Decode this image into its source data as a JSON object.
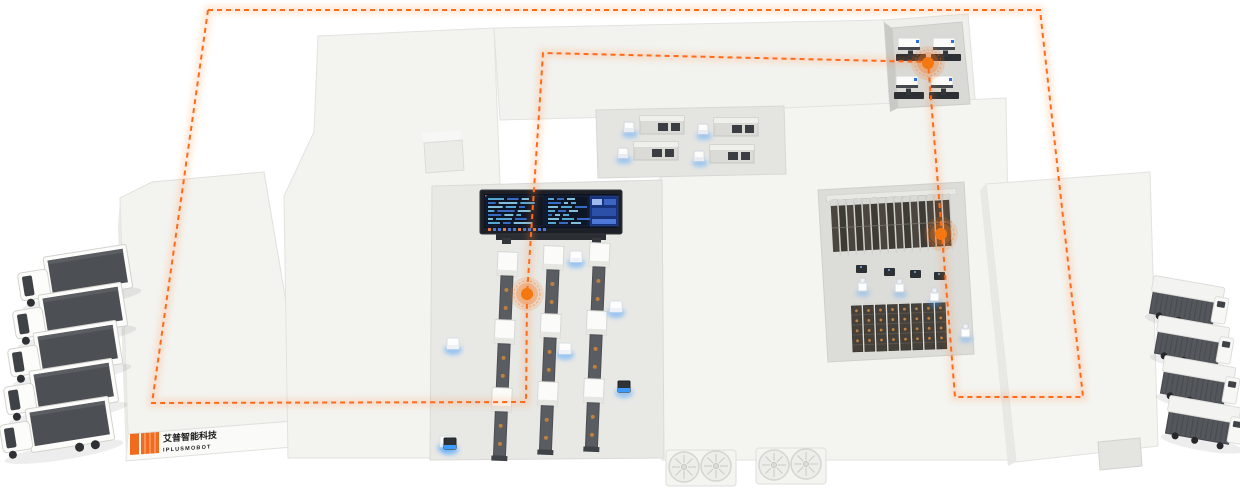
{
  "meta": {
    "title": "smart-factory-isometric-overview",
    "canvas": {
      "width": 1240,
      "height": 488
    }
  },
  "palette": {
    "background": "#ffffff",
    "roof_white": "#f4f4f1",
    "roof_white_2": "#f1f1ee",
    "roof_edge": "#dddddb",
    "floor_gray": "#e8e8e5",
    "floor_dark": "#dcdcd9",
    "wall_shadow": "#c9c9c6",
    "route_orange": "#ff6b1a",
    "node_orange": "#f4770f",
    "glow_blue": "#4aa3ff",
    "machine_dark": "#2e3136",
    "conveyor_gray": "#595c60",
    "rack_dark": "#3e3a34",
    "rack_dark_2": "#45403a",
    "truck_top": "#4c4f54",
    "van_side": "#54575c",
    "vehicle_white": "#fcfcfa",
    "screen_frame": "#1d2026",
    "screen_bg": "#0c1220",
    "screen_right_bg": "#17337c",
    "chip_orange": "#e07b39",
    "chip_blue": "#4d78d8",
    "item_orange_dot": "#c0813f"
  },
  "logo": {
    "line1": "艾普智能科技",
    "line2": "IPLUSMOBOT",
    "mark_color": "#f26a1b",
    "text_color": "#1c1c1a"
  },
  "route": {
    "color": "#ff6b1a",
    "dash": "5 4",
    "closed": true,
    "points": [
      [
        208,
        10
      ],
      [
        1040,
        10
      ],
      [
        1083,
        397
      ],
      [
        955,
        397
      ],
      [
        942,
        235
      ],
      [
        928,
        62
      ],
      [
        543,
        53
      ],
      [
        527,
        295
      ],
      [
        526,
        402
      ],
      [
        152,
        403
      ]
    ]
  },
  "nodes": [
    {
      "name": "route-node-machining-cell",
      "x": 928,
      "y": 63
    },
    {
      "name": "route-node-storage-rack",
      "x": 941,
      "y": 234
    },
    {
      "name": "route-node-production-line",
      "x": 527,
      "y": 294
    }
  ],
  "vehicles": {
    "trucks_left": {
      "count": 5,
      "positions": [
        [
          18,
          252
        ],
        [
          13,
          290
        ],
        [
          8,
          328
        ],
        [
          4,
          366
        ],
        [
          0,
          404
        ]
      ]
    },
    "vans_right": {
      "count": 4,
      "positions": [
        [
          1152,
          282
        ],
        [
          1157,
          322
        ],
        [
          1163,
          362
        ],
        [
          1168,
          402
        ]
      ]
    }
  },
  "production_lines": {
    "columns": [
      {
        "x": 508,
        "y": 252
      },
      {
        "x": 554,
        "y": 246
      },
      {
        "x": 600,
        "y": 243
      }
    ],
    "segments_per_column": 3
  },
  "corridor_machines": [
    [
      640,
      116
    ],
    [
      714,
      118
    ],
    [
      634,
      142
    ],
    [
      710,
      145
    ]
  ],
  "machining_machines": [
    [
      896,
      38
    ],
    [
      931,
      38
    ],
    [
      894,
      76
    ],
    [
      929,
      76
    ]
  ],
  "agvs_white": [
    [
      447,
      338
    ],
    [
      570,
      251
    ],
    [
      610,
      301
    ],
    [
      559,
      343
    ],
    [
      440,
      436
    ]
  ],
  "agvs_dark": [
    [
      618,
      381
    ],
    [
      444,
      438
    ]
  ],
  "rack_robots": [
    [
      858,
      282
    ],
    [
      895,
      283
    ],
    [
      930,
      292
    ],
    [
      961,
      328
    ]
  ],
  "rack_pallets": [
    [
      856,
      265
    ],
    [
      884,
      268
    ],
    [
      910,
      270
    ],
    [
      934,
      272
    ]
  ],
  "racks": {
    "upper": {
      "x": 832,
      "y": 200,
      "columns": 15,
      "col_w": 8,
      "height": 52
    },
    "lower": {
      "x": 852,
      "y": 306,
      "columns": 8,
      "col_w": 12,
      "height": 46
    }
  },
  "screen": {
    "x": 480,
    "y": 190,
    "w": 142,
    "h": 44,
    "row_colors": [
      "#5fb7e8",
      "#3d74d6",
      "#8fd2f2"
    ],
    "left_rows": 7,
    "mid_rows": 7,
    "chips": 12
  },
  "vents": {
    "pedestals": [
      [
        666,
        450
      ],
      [
        756,
        448
      ]
    ],
    "circles": [
      [
        684,
        467
      ],
      [
        716,
        466
      ],
      [
        774,
        465
      ],
      [
        806,
        464
      ]
    ],
    "radius": 15
  }
}
